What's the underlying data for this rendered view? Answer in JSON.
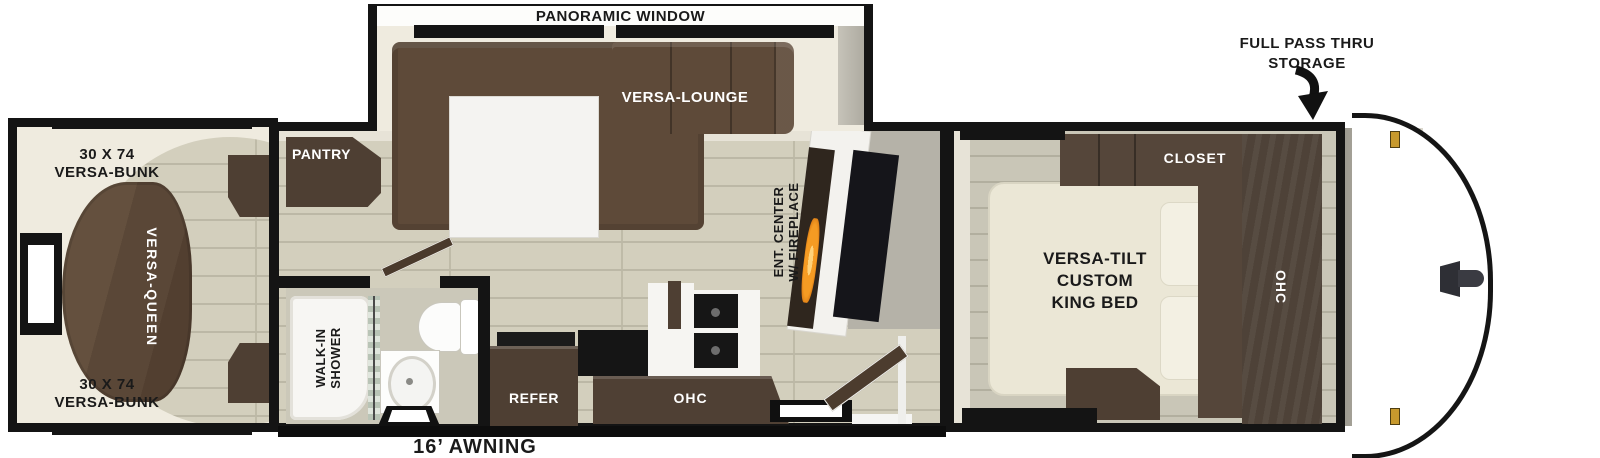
{
  "labels": {
    "panoramic_window": "PANORAMIC WINDOW",
    "full_pass_thru": "FULL PASS THRU\nSTORAGE",
    "awning": "16’ AWNING",
    "bunk_top": "30 X 74\nVERSA-BUNK",
    "bunk_bottom": "30 X 74\nVERSA-BUNK",
    "versa_queen": "VERSA-QUEEN",
    "pantry": "PANTRY",
    "versa_lounge": "VERSA-LOUNGE",
    "ent_center": "ENT. CENTER\nW/ FIREPLACE",
    "walk_in_shower": "WALK-IN\nSHOWER",
    "refer": "REFER",
    "kitchen_ohc": "OHC",
    "king_bed": "VERSA-TILT\nCUSTOM\nKING BED",
    "closet": "CLOSET",
    "bedroom_ohc": "OHC"
  },
  "colors": {
    "wall": "#141414",
    "cream_interior": "#efebdf",
    "wood_floor": "#d3cfbd",
    "bedroom_floor": "#c9c6b7",
    "sofa_brown": "#5e4a39",
    "cabinet_brown": "#4e3f33",
    "bed_cream": "#ebe7d6",
    "gray_wall": "#b5b2a8",
    "flame_orange": "#f59b23",
    "clearance_light_gold": "#c7992d"
  }
}
